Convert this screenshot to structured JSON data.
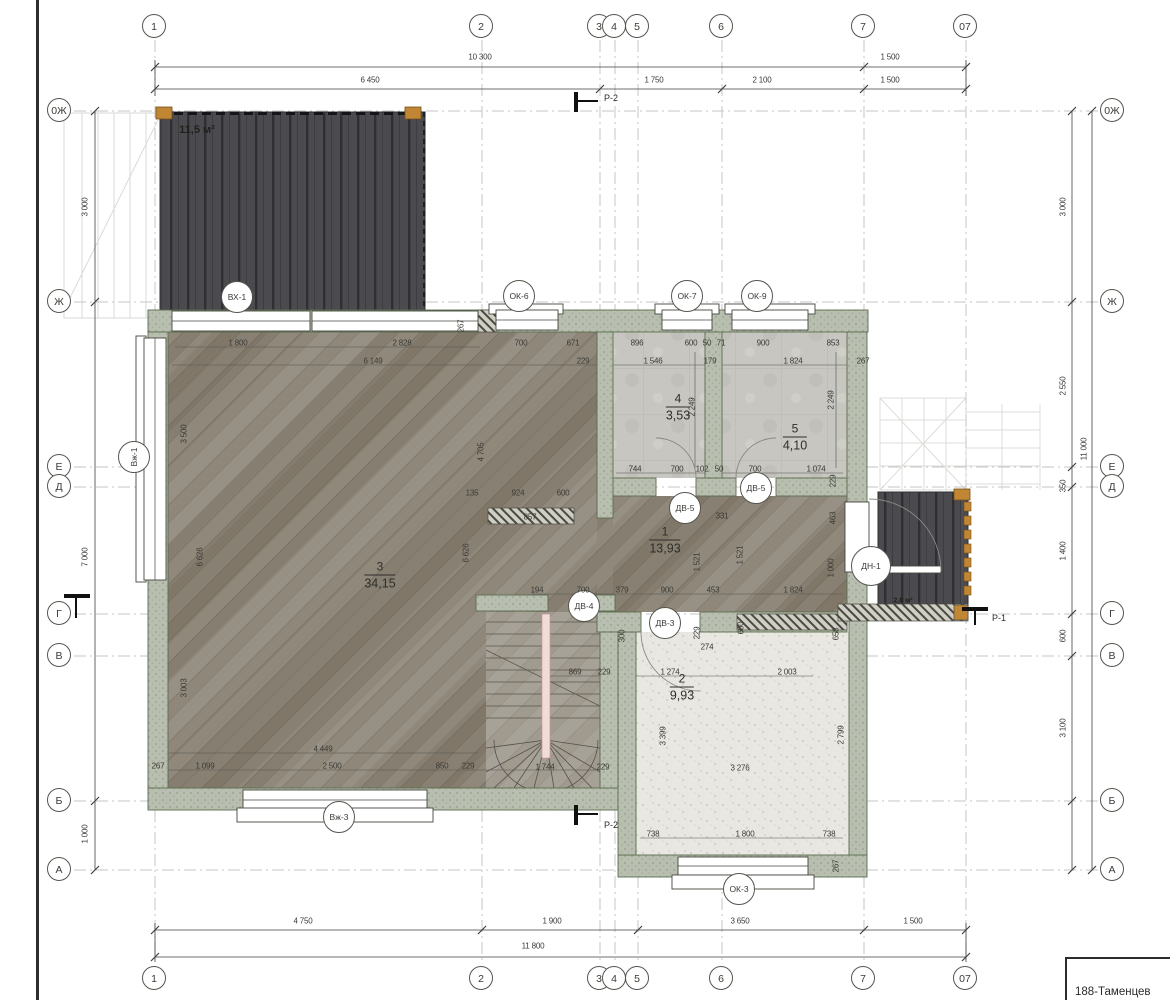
{
  "sheet": {
    "title_block_text": "188-Таменцев"
  },
  "colors": {
    "wall_fill": "#b9bfb0",
    "wall_edge": "#5a6c4e",
    "deck": "#4b4b4f",
    "wood_floor": "#8f887b",
    "tile_floor": "#c7c6c1",
    "speckle_floor": "#e9e7e1",
    "timber_orange": "#c08634",
    "grid_line": "#c6c6c6",
    "line": "#3f3f3f"
  },
  "grid_bubbles": [
    {
      "label": "1",
      "x": 155,
      "y": 27
    },
    {
      "label": "2",
      "x": 482,
      "y": 27
    },
    {
      "label": "3",
      "x": 600,
      "y": 27
    },
    {
      "label": "4",
      "x": 615,
      "y": 27
    },
    {
      "label": "5",
      "x": 638,
      "y": 27
    },
    {
      "label": "6",
      "x": 722,
      "y": 27
    },
    {
      "label": "7",
      "x": 864,
      "y": 27
    },
    {
      "label": "07",
      "x": 966,
      "y": 27
    },
    {
      "label": "1",
      "x": 155,
      "y": 979
    },
    {
      "label": "2",
      "x": 482,
      "y": 979
    },
    {
      "label": "3",
      "x": 600,
      "y": 979
    },
    {
      "label": "4",
      "x": 615,
      "y": 979
    },
    {
      "label": "5",
      "x": 638,
      "y": 979
    },
    {
      "label": "6",
      "x": 722,
      "y": 979
    },
    {
      "label": "7",
      "x": 864,
      "y": 979
    },
    {
      "label": "07",
      "x": 966,
      "y": 979
    },
    {
      "label": "0Ж",
      "x": 60,
      "y": 111
    },
    {
      "label": "Ж",
      "x": 60,
      "y": 302
    },
    {
      "label": "Е",
      "x": 60,
      "y": 467
    },
    {
      "label": "Д",
      "x": 60,
      "y": 487
    },
    {
      "label": "Г",
      "x": 60,
      "y": 614
    },
    {
      "label": "В",
      "x": 60,
      "y": 656
    },
    {
      "label": "Б",
      "x": 60,
      "y": 801
    },
    {
      "label": "А",
      "x": 60,
      "y": 870
    },
    {
      "label": "0Ж",
      "x": 1113,
      "y": 111
    },
    {
      "label": "Ж",
      "x": 1113,
      "y": 302
    },
    {
      "label": "Е",
      "x": 1113,
      "y": 467
    },
    {
      "label": "Д",
      "x": 1113,
      "y": 487
    },
    {
      "label": "Г",
      "x": 1113,
      "y": 614
    },
    {
      "label": "В",
      "x": 1113,
      "y": 656
    },
    {
      "label": "Б",
      "x": 1113,
      "y": 801
    },
    {
      "label": "А",
      "x": 1113,
      "y": 870
    }
  ],
  "component_tags": [
    {
      "label": "ВХ-1",
      "x": 238,
      "y": 298
    },
    {
      "label": "ОК-6",
      "x": 520,
      "y": 297
    },
    {
      "label": "ОК-7",
      "x": 688,
      "y": 297
    },
    {
      "label": "ОК-9",
      "x": 758,
      "y": 297
    },
    {
      "label": "Вж-1",
      "x": 135,
      "y": 458,
      "rot": 1
    },
    {
      "label": "ДВ-5",
      "x": 686,
      "y": 509
    },
    {
      "label": "ДВ-5",
      "x": 757,
      "y": 489
    },
    {
      "label": "ДН-1",
      "x": 872,
      "y": 567,
      "r": 21
    },
    {
      "label": "ДВ-4",
      "x": 585,
      "y": 607
    },
    {
      "label": "ДВ-3",
      "x": 666,
      "y": 624
    },
    {
      "label": "Вж-3",
      "x": 340,
      "y": 818
    },
    {
      "label": "ОК-3",
      "x": 740,
      "y": 890
    }
  ],
  "room_labels": [
    {
      "num": "3",
      "area": "34,15",
      "x": 380,
      "y": 575
    },
    {
      "num": "4",
      "area": "3,53",
      "x": 678,
      "y": 407
    },
    {
      "num": "5",
      "area": "4,10",
      "x": 795,
      "y": 437
    },
    {
      "num": "1",
      "area": "13,93",
      "x": 665,
      "y": 540
    },
    {
      "num": "2",
      "area": "9,93",
      "x": 682,
      "y": 687
    }
  ],
  "area_labels": [
    {
      "text": "11,5 м²",
      "x": 197,
      "y": 130,
      "size": 11
    },
    {
      "text": "2,8 м²",
      "x": 903,
      "y": 601,
      "size": 7
    }
  ],
  "dim_labels": [
    {
      "t": "10 300",
      "x": 480,
      "y": 57
    },
    {
      "t": "1 500",
      "x": 890,
      "y": 57
    },
    {
      "t": "6 450",
      "x": 370,
      "y": 80
    },
    {
      "t": "1 750",
      "x": 654,
      "y": 80
    },
    {
      "t": "2 100",
      "x": 762,
      "y": 80
    },
    {
      "t": "1 500",
      "x": 890,
      "y": 80
    },
    {
      "t": "4 750",
      "x": 303,
      "y": 921
    },
    {
      "t": "1 900",
      "x": 552,
      "y": 921
    },
    {
      "t": "3 650",
      "x": 740,
      "y": 921
    },
    {
      "t": "1 500",
      "x": 913,
      "y": 921
    },
    {
      "t": "11 800",
      "x": 533,
      "y": 946
    },
    {
      "t": "3 000",
      "x": 85,
      "y": 207,
      "v": 1
    },
    {
      "t": "7 000",
      "x": 85,
      "y": 557,
      "v": 1
    },
    {
      "t": "1 000",
      "x": 85,
      "y": 834,
      "v": 1
    },
    {
      "t": "3 000",
      "x": 1063,
      "y": 207,
      "v": 1
    },
    {
      "t": "2 550",
      "x": 1063,
      "y": 386,
      "v": 1
    },
    {
      "t": "350",
      "x": 1063,
      "y": 486,
      "v": 1
    },
    {
      "t": "1 400",
      "x": 1063,
      "y": 551,
      "v": 1
    },
    {
      "t": "600",
      "x": 1063,
      "y": 636,
      "v": 1
    },
    {
      "t": "3 100",
      "x": 1063,
      "y": 728,
      "v": 1
    },
    {
      "t": "11 000",
      "x": 1084,
      "y": 449,
      "v": 1
    },
    {
      "t": "1 800",
      "x": 238,
      "y": 343
    },
    {
      "t": "2 828",
      "x": 402,
      "y": 343
    },
    {
      "t": "6 149",
      "x": 373,
      "y": 361
    },
    {
      "t": "700",
      "x": 521,
      "y": 343
    },
    {
      "t": "671",
      "x": 573,
      "y": 343
    },
    {
      "t": "267",
      "x": 461,
      "y": 326,
      "v": 1
    },
    {
      "t": "896",
      "x": 637,
      "y": 343
    },
    {
      "t": "600",
      "x": 691,
      "y": 343
    },
    {
      "t": "50",
      "x": 707,
      "y": 343
    },
    {
      "t": "71",
      "x": 721,
      "y": 343
    },
    {
      "t": "900",
      "x": 763,
      "y": 343
    },
    {
      "t": "853",
      "x": 833,
      "y": 343
    },
    {
      "t": "229",
      "x": 583,
      "y": 361
    },
    {
      "t": "1 546",
      "x": 653,
      "y": 361
    },
    {
      "t": "179",
      "x": 710,
      "y": 361
    },
    {
      "t": "1 824",
      "x": 793,
      "y": 361
    },
    {
      "t": "267",
      "x": 863,
      "y": 361
    },
    {
      "t": "2 249",
      "x": 692,
      "y": 407,
      "v": 1
    },
    {
      "t": "2 249",
      "x": 831,
      "y": 400,
      "v": 1
    },
    {
      "t": "744",
      "x": 635,
      "y": 469
    },
    {
      "t": "700",
      "x": 677,
      "y": 469
    },
    {
      "t": "102",
      "x": 702,
      "y": 469
    },
    {
      "t": "50",
      "x": 719,
      "y": 469
    },
    {
      "t": "700",
      "x": 755,
      "y": 469
    },
    {
      "t": "1 074",
      "x": 816,
      "y": 469
    },
    {
      "t": "229",
      "x": 833,
      "y": 481,
      "v": 1
    },
    {
      "t": "3 500",
      "x": 184,
      "y": 434,
      "v": 1
    },
    {
      "t": "6 626",
      "x": 200,
      "y": 557,
      "v": 1
    },
    {
      "t": "6 626",
      "x": 466,
      "y": 553,
      "v": 1
    },
    {
      "t": "4 705",
      "x": 481,
      "y": 452,
      "v": 1
    },
    {
      "t": "3 003",
      "x": 184,
      "y": 688,
      "v": 1
    },
    {
      "t": "135",
      "x": 472,
      "y": 493
    },
    {
      "t": "924",
      "x": 518,
      "y": 493
    },
    {
      "t": "600",
      "x": 563,
      "y": 493
    },
    {
      "t": "857",
      "x": 530,
      "y": 517
    },
    {
      "t": "331",
      "x": 722,
      "y": 516
    },
    {
      "t": "1 521",
      "x": 697,
      "y": 562,
      "v": 1
    },
    {
      "t": "1 521",
      "x": 740,
      "y": 555,
      "v": 1
    },
    {
      "t": "463",
      "x": 833,
      "y": 518,
      "v": 1
    },
    {
      "t": "1 000",
      "x": 831,
      "y": 568,
      "v": 1
    },
    {
      "t": "194",
      "x": 537,
      "y": 590
    },
    {
      "t": "700",
      "x": 583,
      "y": 590
    },
    {
      "t": "379",
      "x": 622,
      "y": 590
    },
    {
      "t": "900",
      "x": 667,
      "y": 590
    },
    {
      "t": "453",
      "x": 713,
      "y": 590
    },
    {
      "t": "1 824",
      "x": 793,
      "y": 590
    },
    {
      "t": "300",
      "x": 622,
      "y": 636,
      "v": 1
    },
    {
      "t": "600",
      "x": 741,
      "y": 628,
      "v": 1
    },
    {
      "t": "229",
      "x": 697,
      "y": 633,
      "v": 1
    },
    {
      "t": "274",
      "x": 707,
      "y": 647
    },
    {
      "t": "869",
      "x": 575,
      "y": 672
    },
    {
      "t": "229",
      "x": 604,
      "y": 672
    },
    {
      "t": "1 274",
      "x": 670,
      "y": 672
    },
    {
      "t": "2 003",
      "x": 787,
      "y": 672
    },
    {
      "t": "3 399",
      "x": 663,
      "y": 736,
      "v": 1
    },
    {
      "t": "658",
      "x": 836,
      "y": 634,
      "v": 1
    },
    {
      "t": "2 799",
      "x": 841,
      "y": 735,
      "v": 1
    },
    {
      "t": "4 449",
      "x": 323,
      "y": 749
    },
    {
      "t": "267",
      "x": 158,
      "y": 766
    },
    {
      "t": "1 099",
      "x": 205,
      "y": 766
    },
    {
      "t": "2 500",
      "x": 332,
      "y": 766
    },
    {
      "t": "850",
      "x": 442,
      "y": 766
    },
    {
      "t": "229",
      "x": 468,
      "y": 766
    },
    {
      "t": "1 744",
      "x": 545,
      "y": 767
    },
    {
      "t": "229",
      "x": 603,
      "y": 767
    },
    {
      "t": "3 276",
      "x": 740,
      "y": 768
    },
    {
      "t": "738",
      "x": 653,
      "y": 834
    },
    {
      "t": "1 800",
      "x": 745,
      "y": 834
    },
    {
      "t": "738",
      "x": 829,
      "y": 834
    },
    {
      "t": "267",
      "x": 836,
      "y": 866,
      "v": 1
    }
  ],
  "section_markers": [
    {
      "label": "Р-2",
      "bar": [
        574,
        92,
        4,
        20
      ],
      "line": [
        578,
        100,
        20,
        2
      ],
      "lx": 604,
      "ly": 93
    },
    {
      "label": "Р-2",
      "bar": [
        574,
        805,
        4,
        20
      ],
      "line": [
        578,
        813,
        20,
        2
      ],
      "lx": 604,
      "ly": 820
    },
    {
      "label": "Р-1",
      "bar": [
        962,
        607,
        26,
        4
      ],
      "line": [
        974,
        611,
        2,
        14
      ],
      "lx": 992,
      "ly": 613
    },
    {
      "label": "",
      "bar": [
        64,
        594,
        26,
        4
      ],
      "line": [
        75,
        598,
        2,
        20
      ],
      "lx": 0,
      "ly": 0
    }
  ]
}
